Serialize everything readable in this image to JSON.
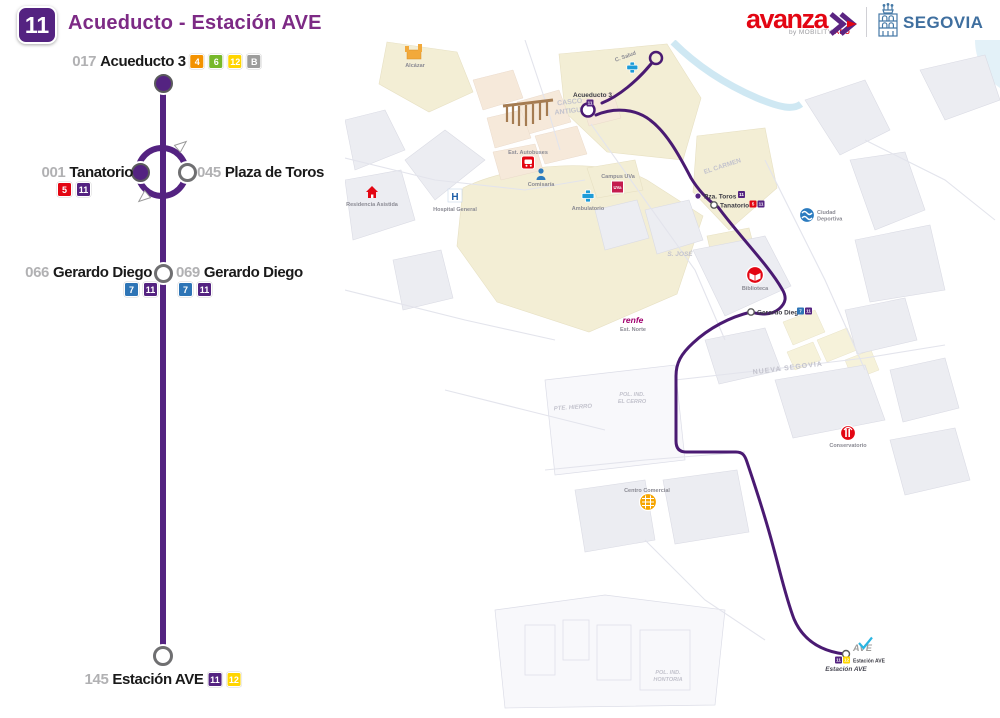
{
  "header": {
    "route_number": "11",
    "title": "Acueducto - Estación AVE",
    "avanza": {
      "word": "avanza",
      "byline": "by MOBILITY ",
      "byline_accent": "ADO"
    },
    "city": "SEGOVIA"
  },
  "colors": {
    "route_purple": "#542381",
    "map_route_purple": "#4a1a72",
    "title_purple": "#7d2a85",
    "brand_red": "#e30613",
    "segovia_blue": "#3f6f9f",
    "line_badge_colors": {
      "4": "#f39200",
      "5": "#e30613",
      "6": "#76b82a",
      "7": "#2e75b6",
      "11": "#542381",
      "12": "#ffd500",
      "B": "#9d9d9c"
    }
  },
  "diagram": {
    "stops": [
      {
        "code": "017",
        "name": "Acueducto 3",
        "badges": [
          "4",
          "6",
          "12",
          "B"
        ]
      },
      {
        "code": "001",
        "name": "Tanatorio",
        "badges": [
          "5",
          "11"
        ]
      },
      {
        "code": "045",
        "name": "Plaza de Toros",
        "badges": []
      },
      {
        "code": "066",
        "name": "Gerardo Diego",
        "badges": [
          "7",
          "11"
        ]
      },
      {
        "code": "069",
        "name": "Gerardo Diego",
        "badges": [
          "7",
          "11"
        ]
      },
      {
        "code": "145",
        "name": "Estación AVE",
        "badges": [
          "11",
          "12"
        ]
      }
    ]
  },
  "map": {
    "areas": {
      "casco_antiguo": [
        "CASCO",
        "ANTIGUO"
      ],
      "el_carmen": "EL CARMEN",
      "s_jose": "S. JOSÉ",
      "nueva_segovia": "NUEVA SEGOVIA",
      "pte_hierro": "PTE. HIERRO",
      "pol_ind_el_cerro": [
        "POL. IND.",
        "EL CERRO"
      ],
      "pol_ind_hontoria": [
        "POL. IND.",
        "HONTORIA"
      ]
    },
    "pois": {
      "alcazar": "Alcázar",
      "residencia_asistida": "Residencia Asistida",
      "hospital_general": "Hospital General",
      "est_autobuses": "Est. Autobuses",
      "comisaria": "Comisaría",
      "ambulatorio": "Ambulatorio",
      "c_salud": "C. Salud",
      "campus_uva": "Campus UVa",
      "uva_abbrev": "UVa",
      "ciudad_deportiva": [
        "Ciudad",
        "Deportiva"
      ],
      "biblioteca": "Biblioteca",
      "renfe": "renfe",
      "est_norte": "Est. Norte",
      "conservatorio": "Conservatorio",
      "centro_comercial": "Centro Comercial",
      "ave_logo": "AVE",
      "estacion_ave_caption": "Estación AVE"
    },
    "stops": {
      "acueducto3": {
        "name": "Acueducto 3",
        "badges": [
          "11"
        ]
      },
      "pza_toros": {
        "name": "Pza. Toros",
        "badges": [
          "11"
        ]
      },
      "tanatorio": {
        "name": "Tanatorio",
        "badges": [
          "5",
          "11"
        ]
      },
      "gerardo_diego": {
        "name": "Gerardo Diego",
        "badges": [
          "7",
          "11"
        ]
      },
      "estacion_ave": {
        "name": "Estación AVE",
        "badges": [
          "11",
          "12"
        ]
      }
    }
  }
}
